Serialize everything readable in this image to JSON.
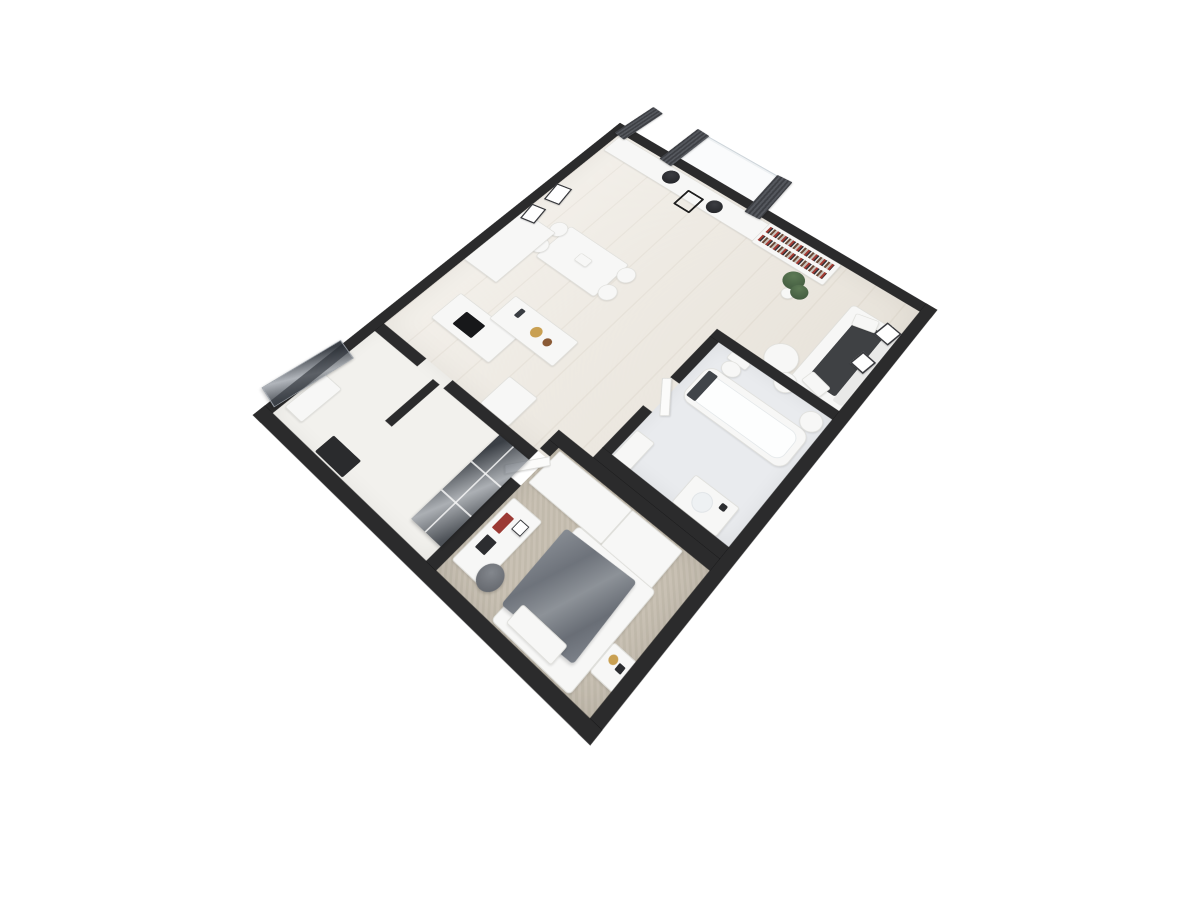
{
  "scene": {
    "type": "3d-floor-plan-render",
    "view": "rotated top-down perspective",
    "background": "#ffffff",
    "visible_text": "none"
  },
  "colors": {
    "wall": "#2b2b2c",
    "wood": "#ece7de",
    "carpet": "#c6beb0",
    "bath_floor": "#e9ebee",
    "hall_floor": "#f2f1ed",
    "white_furn": "#f7f7f6",
    "charcoal": "#3f4144",
    "blanket_gray": "#747980",
    "curtain_gray": "#46484d",
    "gold": "#c9a052",
    "accent_red": "#9c3a34",
    "plant_green": "#46603f"
  },
  "rooms": [
    {
      "id": "living-dining",
      "floor": "light-wood",
      "furniture": [
        "media-console",
        "projection-window",
        "curtains",
        "two-speakers",
        "side-stand",
        "bookshelf-with-books",
        "potted-plant",
        "sofa-charcoal-seats",
        "nesting-coffee-tables",
        "dining-table",
        "four-chairs",
        "framed-wall-art-x4"
      ]
    },
    {
      "id": "kitchen",
      "floor": "light-wood",
      "furniture": [
        "tall-cabinet",
        "counter-with-cooktop",
        "island-with-faucet",
        "fruit-bowls",
        "appliance-block"
      ]
    },
    {
      "id": "bathroom",
      "floor": "light-tile",
      "furniture": [
        "bathtub-with-towel",
        "toilet",
        "vanity-with-sink",
        "shelf-unit",
        "laundry-basket"
      ]
    },
    {
      "id": "bedroom",
      "floor": "beige-carpet",
      "furniture": [
        "bed-gray-blanket",
        "wardrobe-units",
        "nightstand-gold-decor",
        "desk-with-books",
        "pouf",
        "open-door"
      ]
    },
    {
      "id": "hallway-entry",
      "floor": "pale",
      "furniture": [
        "glass-front-closet",
        "leaning-dark-panel",
        "black-bench",
        "entry-shelf",
        "partition-wall"
      ]
    }
  ]
}
